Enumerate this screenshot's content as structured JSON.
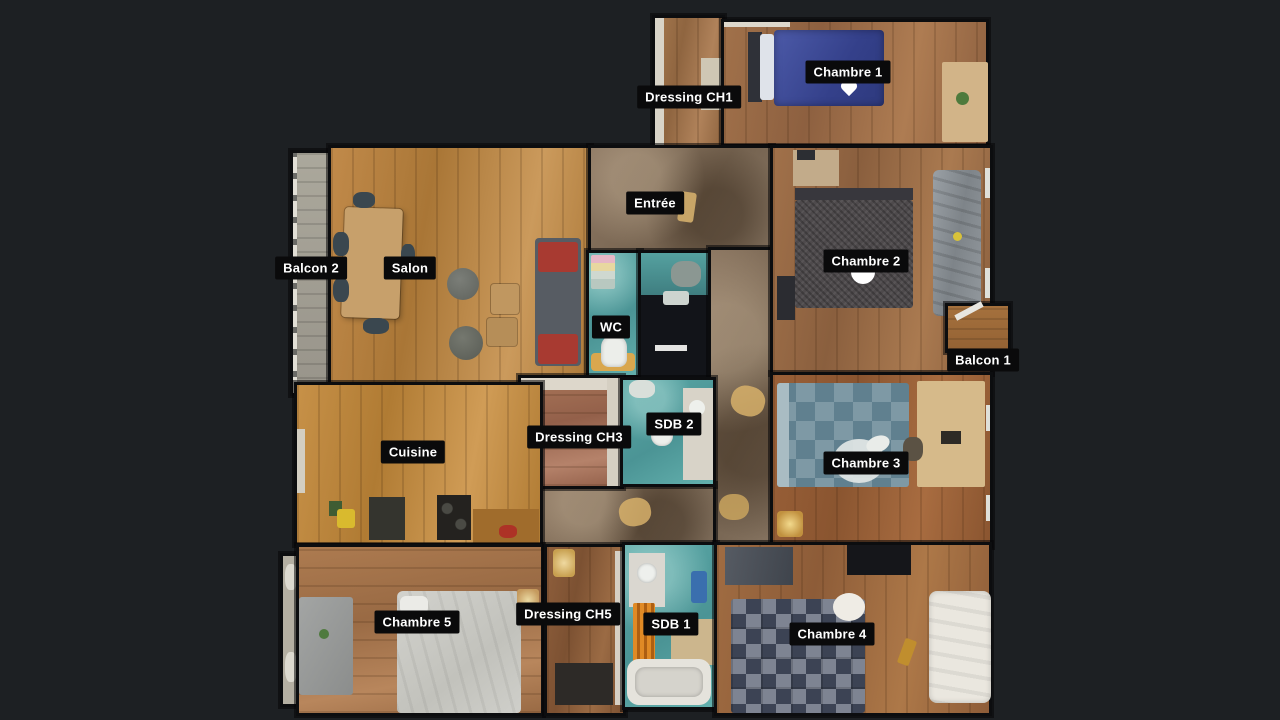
{
  "scene": {
    "view": "3D dollhouse top-down floor plan of an apartment",
    "background_color": "#1d2023"
  },
  "label_style": {
    "background": "#0a0a0b",
    "text_color": "#ffffff"
  },
  "rooms": [
    {
      "id": "dressing-ch1",
      "label": "Dressing CH1"
    },
    {
      "id": "chambre-1",
      "label": "Chambre 1"
    },
    {
      "id": "entree",
      "label": "Entrée"
    },
    {
      "id": "balcon-2",
      "label": "Balcon 2"
    },
    {
      "id": "salon",
      "label": "Salon"
    },
    {
      "id": "chambre-2",
      "label": "Chambre 2"
    },
    {
      "id": "wc",
      "label": "WC"
    },
    {
      "id": "balcon-1",
      "label": "Balcon 1"
    },
    {
      "id": "dressing-ch3",
      "label": "Dressing CH3"
    },
    {
      "id": "sdb-2",
      "label": "SDB 2"
    },
    {
      "id": "chambre-3",
      "label": "Chambre 3"
    },
    {
      "id": "cuisine",
      "label": "Cuisine"
    },
    {
      "id": "chambre-5",
      "label": "Chambre 5"
    },
    {
      "id": "dressing-ch5",
      "label": "Dressing CH5"
    },
    {
      "id": "sdb-1",
      "label": "SDB 1"
    },
    {
      "id": "chambre-4",
      "label": "Chambre 4"
    }
  ],
  "markers": [
    {
      "id": "view-marker-chambre-1",
      "shape": "heart",
      "color": "#ffffff"
    },
    {
      "id": "view-marker-chambre-2",
      "shape": "semicircle",
      "color": "#ffffff"
    },
    {
      "id": "view-marker-chambre-3",
      "shape": "dot",
      "color": "#e9ece9"
    }
  ],
  "palette": {
    "floor_wood_light": "#c08a4c",
    "floor_wood_medium": "#9a6b45",
    "floor_wood_red": "#96613d",
    "floor_stone_hall": "#85705a",
    "bathroom_teal": "#57a3a2",
    "bed_blue": "#3f4d99",
    "bed_gray_knit": "#4e494b",
    "bed_patch_blue": "#7e99a5",
    "bed_plaid_dark": "#3b4253",
    "bed_light_gray": "#cdcdc9",
    "sofa_red_cushion": "#a83a31",
    "radiator_orange": "#d97f1f",
    "balcony_gray": "#a9a396"
  }
}
